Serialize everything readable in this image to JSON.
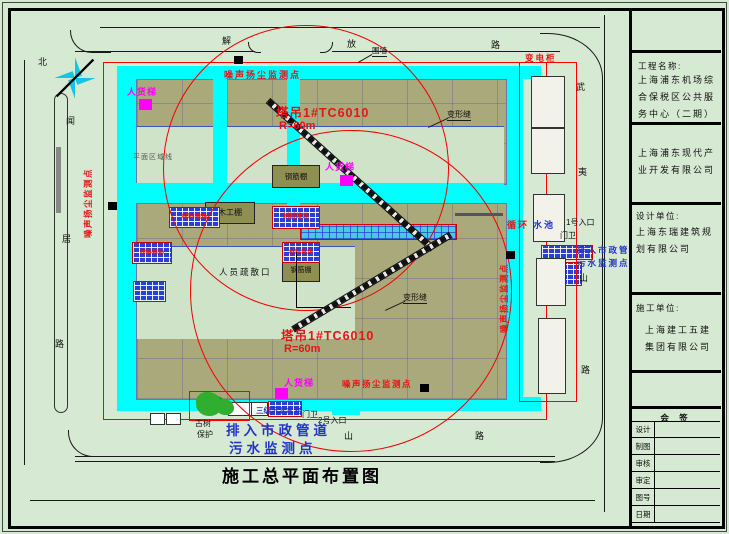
{
  "drawing_title": "施工总平面布置图",
  "compass": {
    "north": "北"
  },
  "roads": {
    "left": [
      "闻",
      "居",
      "路"
    ],
    "top": [
      "解",
      "放",
      "路"
    ],
    "right": [
      "武",
      "夷",
      "山",
      "路"
    ],
    "bottom": [
      "山",
      "路"
    ]
  },
  "cranes": {
    "crane1": {
      "name": "塔吊1#TC6010",
      "radius": "R=60m"
    },
    "crane2": {
      "name": "塔吊1#TC6010",
      "radius": "R=60m"
    }
  },
  "labels": {
    "noise_monitor": "噪声扬尘监测点",
    "sewage_line1": "排入市政管道",
    "sewage_line2": "污水监测点",
    "sewage_small1": "排入市政管",
    "sewage_small2": "污水监测点",
    "hoist": "人货梯",
    "rebar_shed": "钢筋棚",
    "wood_shed": "木工棚",
    "evacuation": "人员疏散口",
    "deformation_joint": "变形缝",
    "power_cabinet": "变电柜",
    "fence": "围墙",
    "entrance1": "1号入口",
    "entrance2": "2号入口",
    "guard": "门卫",
    "old_tree": "古树",
    "old_tree_protect": "保护",
    "circulating": "循环",
    "pool": "水池",
    "sediment_pool": "三级沉淀水池",
    "region_line": "平面区域线",
    "stockyard": "材料堆场"
  },
  "title_block": {
    "project_label": "工程名称:",
    "project_name": "上海浦东机场综合保税区公共服务中心（二期）",
    "owner_name": "上海浦东现代产业开发有限公司",
    "design_label": "设计单位:",
    "design_name": "上海东瑞建筑规划有限公司",
    "construction_label": "施工单位:",
    "construction_name": "上海建工五建集团有限公司",
    "sign_header": "会 签",
    "sign_rows": [
      "设计",
      "制图",
      "审核",
      "审定",
      "图号",
      "日期"
    ]
  }
}
